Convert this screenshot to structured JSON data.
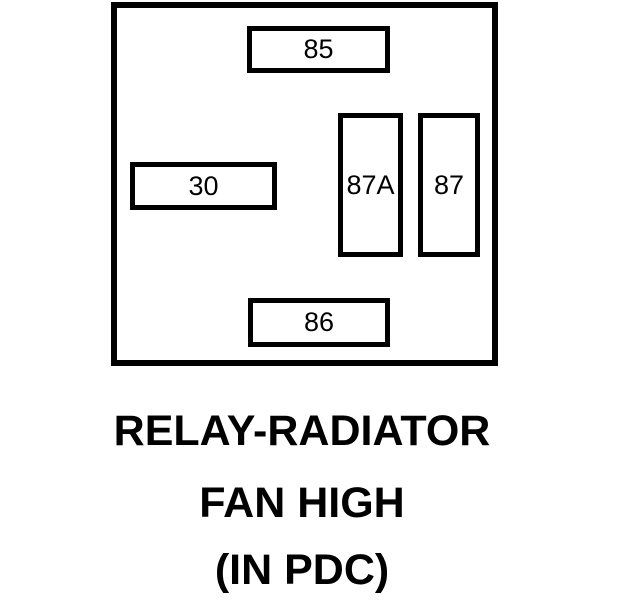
{
  "diagram": {
    "type": "relay-pinout",
    "colors": {
      "line": "#000000",
      "background": "#ffffff",
      "text": "#000000"
    },
    "relay": {
      "pins": [
        {
          "label": "85",
          "position": "top-center"
        },
        {
          "label": "30",
          "position": "middle-left"
        },
        {
          "label": "87A",
          "position": "middle-right-inner"
        },
        {
          "label": "87",
          "position": "middle-right-outer"
        },
        {
          "label": "86",
          "position": "bottom-center"
        }
      ]
    },
    "caption": {
      "line1": "RELAY-RADIATOR",
      "line2": "FAN HIGH",
      "line3": "(IN PDC)"
    }
  }
}
